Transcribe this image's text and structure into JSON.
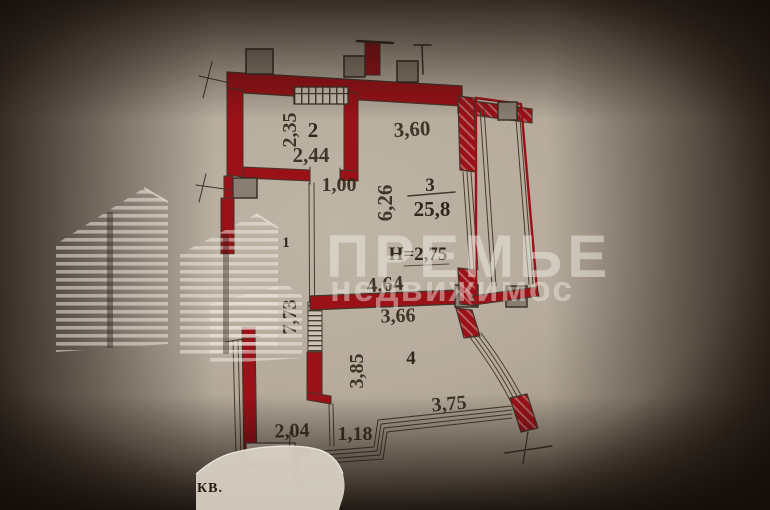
{
  "watermark": {
    "line1": "ПРЕМЬЕ",
    "line2": "недвижимос"
  },
  "caption": "КВ.",
  "rooms": {
    "r1": {
      "number": "1",
      "length": "7,73"
    },
    "r2": {
      "number": "2",
      "dim_depth": "2,35",
      "dim_width": "2,44"
    },
    "r3": {
      "number": "3",
      "area": "25,8",
      "dim_top": "3,60",
      "dim_side": "6,26",
      "dim_bottom": "4,64",
      "height_note": "Н=2,75"
    },
    "r4": {
      "number": "4",
      "dim_top": "3,66",
      "dim_side": "3,85"
    }
  },
  "dims": {
    "hall_door": "1,00",
    "balcony_edge": "3,75",
    "bottom_left": "2,04",
    "bottom_inner": "1,18"
  },
  "colors": {
    "wall_red": "#a31018",
    "paper": "#c3b9ab",
    "ink": "#463a2d",
    "vent_block": "#8f8679"
  }
}
